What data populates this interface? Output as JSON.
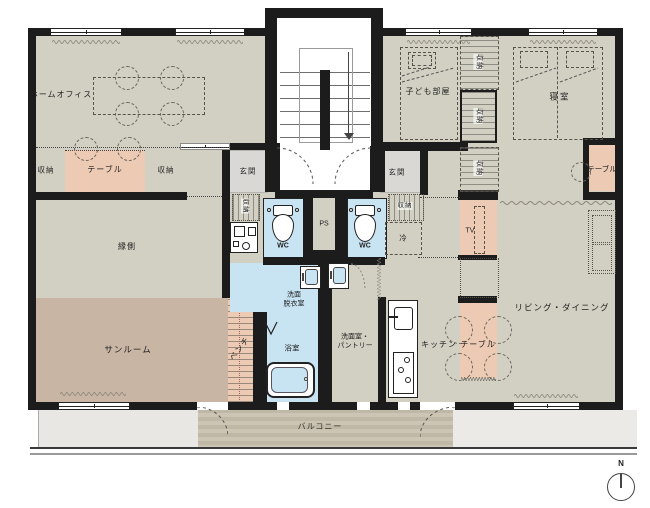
{
  "labels": {
    "home_office": "ホームオフィス",
    "storage": "収納",
    "table": "テーブル",
    "engawa": "縁側",
    "sunroom": "サンルーム",
    "bench": "ベンチ",
    "entrance": "玄関",
    "wc": "WC",
    "ps": "PS",
    "fridge": "冷",
    "kids_room": "子ども部屋",
    "bedroom": "寝室",
    "tv": "TV",
    "living_dining": "リビング・ダイニング",
    "washroom_line1": "洗面",
    "washroom_line2": "脱衣室",
    "bathroom": "浴室",
    "pantry_line1": "洗面室・",
    "pantry_line2": "パントリー",
    "kitchen": "キッチン",
    "balcony": "バルコニー",
    "compass_north": "N"
  },
  "colors": {
    "wall": "#1c1c1c",
    "floor_beige": "#d2d0c3",
    "sunroom_brown": "#c9b5a4",
    "accent_pink": "#eccab3",
    "wet_area_blue": "#c8e4f2",
    "entrance_gray": "#d9d8d5",
    "deck_stripe_a": "#cdc5b4",
    "deck_stripe_b": "#c0b8a6"
  }
}
